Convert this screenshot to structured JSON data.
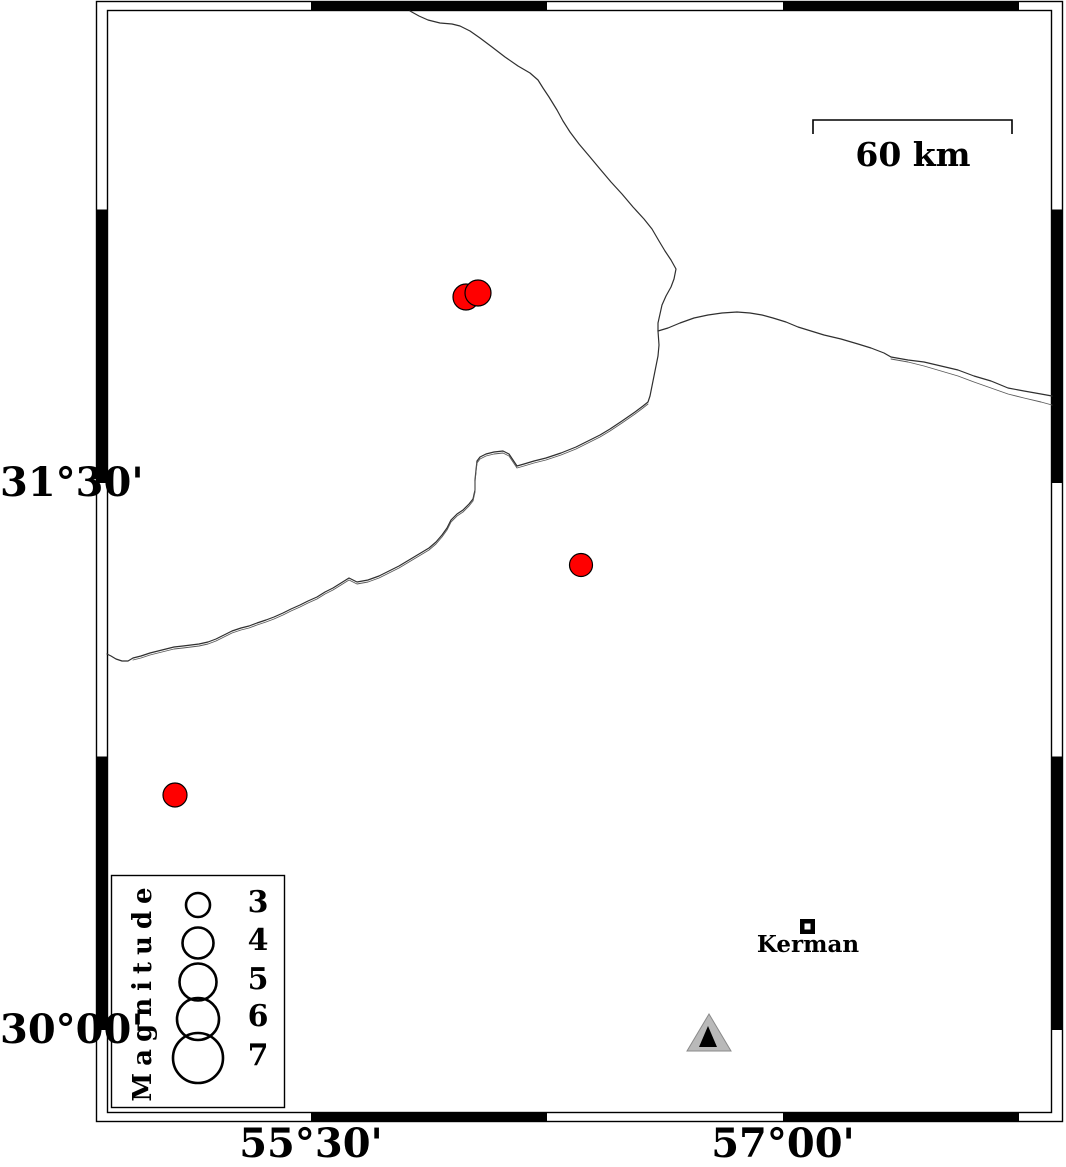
{
  "axes": {
    "left": [
      {
        "label": "31°30'",
        "y": 483
      },
      {
        "label": "30°00'",
        "y": 1030
      }
    ],
    "bottom": [
      {
        "label": "55°30'",
        "x": 311
      },
      {
        "label": "57°00'",
        "x": 783
      }
    ]
  },
  "scalebar": {
    "label": "60 km"
  },
  "city": {
    "label": "Kerman"
  },
  "legend": {
    "title": "Magnitude",
    "circle_x": 198,
    "entries": [
      {
        "label": "3",
        "cy": 905,
        "r": 12
      },
      {
        "label": "4",
        "cy": 943,
        "r": 15.5
      },
      {
        "label": "5",
        "cy": 982,
        "r": 18.5
      },
      {
        "label": "6",
        "cy": 1019,
        "r": 21
      },
      {
        "label": "7",
        "cy": 1058,
        "r": 25
      }
    ]
  },
  "earthquakes": [
    {
      "x": 466,
      "y": 297,
      "r": 13
    },
    {
      "x": 478,
      "y": 293,
      "r": 13
    },
    {
      "x": 581,
      "y": 565,
      "r": 11.5
    },
    {
      "x": 175,
      "y": 795,
      "r": 12
    }
  ],
  "station": {
    "outer_color": "#b9b9b9",
    "inner_color": "#000000"
  },
  "colors": {
    "earthquake_fill": "#ff0000",
    "frame": "#000000",
    "boundary_line": "#2f2f2f"
  }
}
